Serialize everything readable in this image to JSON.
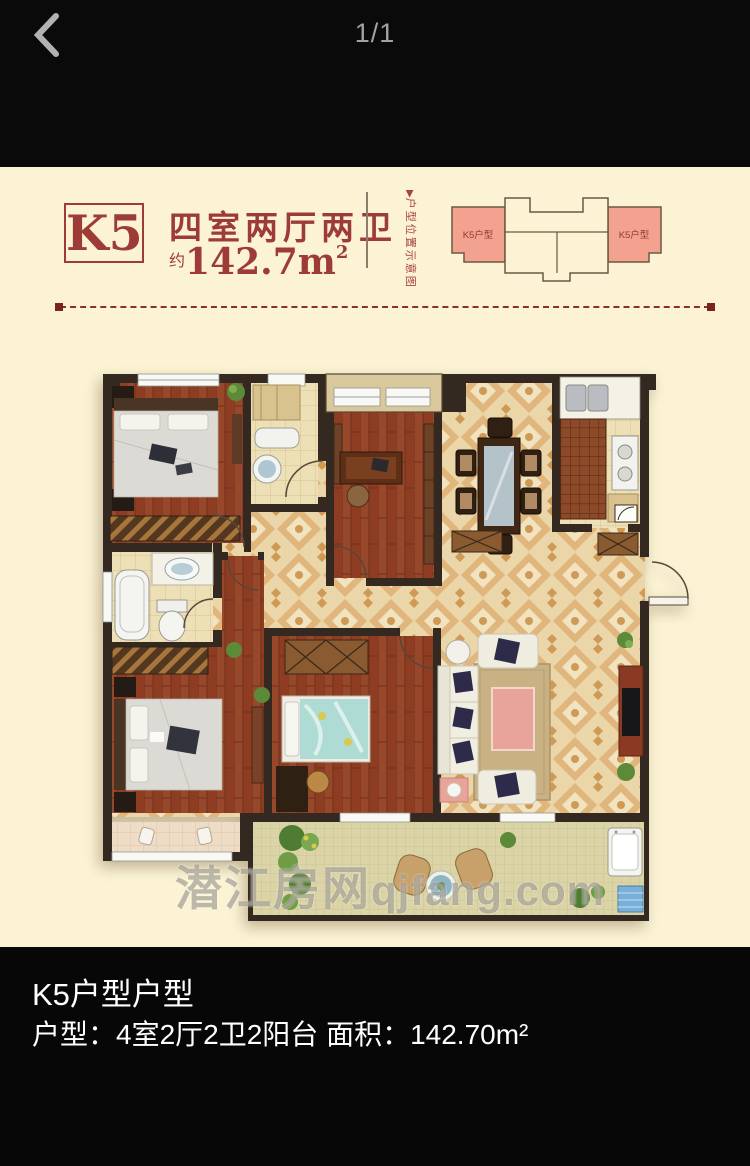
{
  "header": {
    "page_indicator": "1/1",
    "back_icon": "chevron-left"
  },
  "title": {
    "unit_code": "K5",
    "layout": "四室两厅两卫",
    "area_prefix": "约",
    "area_value": "142.7m",
    "area_sup": "2"
  },
  "side_label": {
    "arrow": "▶",
    "text": "户型位置示意图"
  },
  "diagram": {
    "left_wing_label": "K5户型",
    "right_wing_label": "K5户型"
  },
  "watermark": {
    "cjk": "潜江房网",
    "latin": "qjfang.com"
  },
  "footer": {
    "title": "K5户型户型",
    "subtitle": "户型：4室2厅2卫2阳台 面积：142.70m²"
  },
  "floorplan": {
    "rooms_depicted": [
      "bedroom",
      "bathroom",
      "study",
      "dining-room",
      "kitchen",
      "master-bathroom",
      "master-bedroom",
      "kids-bedroom",
      "living-room",
      "entry-hall",
      "balcony",
      "bay-window"
    ],
    "colors": {
      "page_cream": "#fbf3d4",
      "bar_black": "#0b0a0a",
      "accent_red": "#9d3b36",
      "wing_salmon": "#f2a28f",
      "wall_dark": "#342920",
      "wood_floor": "#8e3d23",
      "tile_beige": "#ead6a9",
      "watermark_gray": "#766e60"
    }
  }
}
